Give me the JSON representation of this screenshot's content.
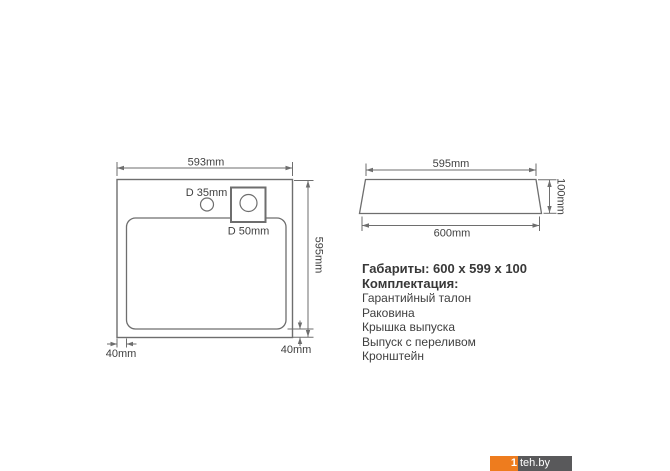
{
  "top_view": {
    "width_label": "593mm",
    "height_label": "595mm",
    "small_hole_label": "D 35mm",
    "large_hole_label": "D 50mm",
    "left_offset_label": "40mm",
    "right_offset_label": "40mm"
  },
  "side_view": {
    "top_width_label": "595mm",
    "height_label": "100mm",
    "bottom_width_label": "600mm"
  },
  "specs": {
    "dimensions_line": "Габариты: 600 x 599 x 100",
    "kit_title": "Комплектация:",
    "kit_items": [
      "Гарантийный талон",
      "Раковина",
      "Крышка выпуска",
      "Выпуск с переливом",
      "Кронштейн"
    ]
  },
  "watermark": {
    "prefix": "1",
    "site": "teh.by",
    "orange_color": "#ee7c1e",
    "gray_color": "#59595b"
  },
  "colors": {
    "line": "#6e6e6e",
    "dimension_text": "#3f3f3f",
    "body_text": "#3f3f3f",
    "background": "#ffffff"
  }
}
